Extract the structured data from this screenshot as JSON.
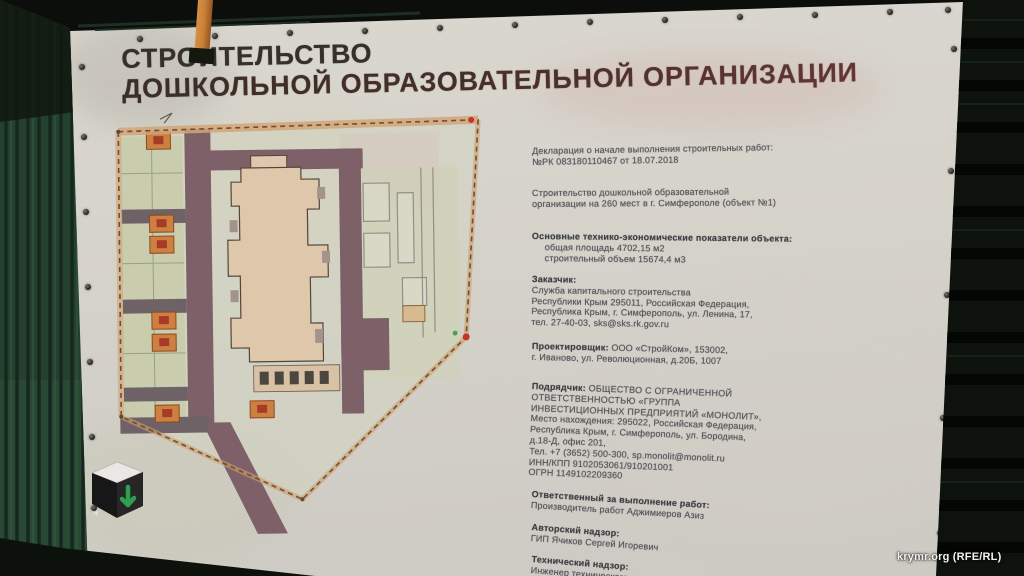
{
  "photo": {
    "watermark": "krymr.org (RFE/RL)"
  },
  "banner": {
    "title": {
      "line1": "СТРОИТЕЛЬСТВО",
      "line2": "ДОШКОЛЬНОЙ ОБРАЗОВАТЕЛЬНОЙ ОРГАНИЗАЦИИ"
    },
    "blocks": {
      "declaration": {
        "lines": [
          "Декларация о начале выполнения строительных работ:",
          "№РК 083180110467 от 18.07.2018"
        ]
      },
      "project": {
        "lines": [
          "Строительство дошкольной образовательной",
          "организации на 260 мест в г. Симферополе (объект №1)"
        ]
      },
      "indicators": {
        "heading": "Основные технико-экономические показатели объекта:",
        "lines": [
          "общая площадь 4702,15 м2",
          "строительный объем 15674,4 м3"
        ]
      },
      "customer": {
        "heading": "Заказчик:",
        "lines": [
          "Служба капитального строительства",
          "Республики Крым 295011, Российская Федерация,",
          "Республика Крым, г. Симферополь, ул. Ленина, 17,",
          "тел. 27-40-03, sks@sks.rk.gov.ru"
        ]
      },
      "designer": {
        "heading": "Проектировщик:",
        "heading_rest": "ООО «СтройКом», 153002,",
        "lines": [
          "г. Иваново, ул. Революционная, д.20Б, 1007"
        ]
      },
      "contractor": {
        "heading": "Подрядчик:",
        "heading_rest": "ОБЩЕСТВО С ОГРАНИЧЕННОЙ",
        "lines": [
          "ОТВЕТСТВЕННОСТЬЮ «ГРУППА",
          "ИНВЕСТИЦИОННЫХ ПРЕДПРИЯТИЙ «МОНОЛИТ»,",
          "Место нахождения: 295022, Российская Федерация,",
          "Республика Крым, г. Симферополь, ул. Бородина,",
          "д.18-Д, офис 201,",
          "Тел. +7 (3652) 500-300, sp.monolit@monolit.ru",
          "ИНН/КПП 9102053061/910201001",
          "ОГРН 1149102209360"
        ]
      },
      "responsible": {
        "heading": "Ответственный за выполнение работ:",
        "lines": [
          "Производитель работ Аджимиеров Азиз"
        ]
      },
      "author_supervision": {
        "heading": "Авторский надзор:",
        "lines": [
          "ГИП Ячиков Сергей Игоревич"
        ]
      },
      "tech_supervision": {
        "heading": "Технический надзор:",
        "lines": [
          "Инженер технического надзора"
        ]
      }
    },
    "colors": {
      "banner_bg": "#d6d3ca",
      "fence_green": "#24402f",
      "road_mauve": "#7d6068",
      "building_tan": "#dfc7ab",
      "boundary_orange": "#b5764a",
      "plot_green": "#c9cdad",
      "play_orange": "#cd8040",
      "logo_green": "#2f9e4f"
    }
  }
}
